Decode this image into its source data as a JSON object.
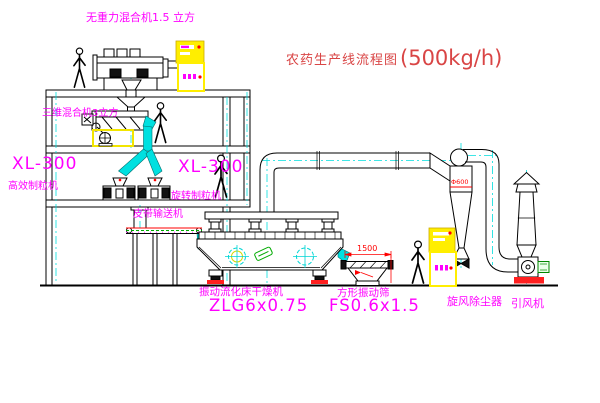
{
  "title": {
    "name": "农药生产线流程图",
    "capacity": "(500kg/h)"
  },
  "labels": {
    "top_mixer": "无重力混合机1.5 立方",
    "second_mixer": "三维混合机3立方",
    "left_granulator_model": "XL-300",
    "left_granulator_name": "高效制粒机",
    "mid_granulator_model": "XL-300",
    "mid_granulator_name": "旋转制粒机",
    "belt_conveyor": "皮带输送机",
    "dryer_name": "振动流化床干燥机",
    "dryer_model": "ZLG6x0.75",
    "screen_name": "方形振动筛",
    "screen_model": "FS0.6x1.5",
    "cyclone_name": "旋风除尘器",
    "fan_name": "引风机"
  },
  "annotations": {
    "cyclone_diameter": "Φ600",
    "screen_width_dim": "1500"
  },
  "colors": {
    "label_magenta": "#ff00ff",
    "title_red": "#d94545",
    "annotation_red": "#ff0000",
    "cabinet_yellow": "#ffee00",
    "centerline_cyan": "#00dede",
    "detail_green": "#00aa00",
    "linework_black": "#000000"
  }
}
